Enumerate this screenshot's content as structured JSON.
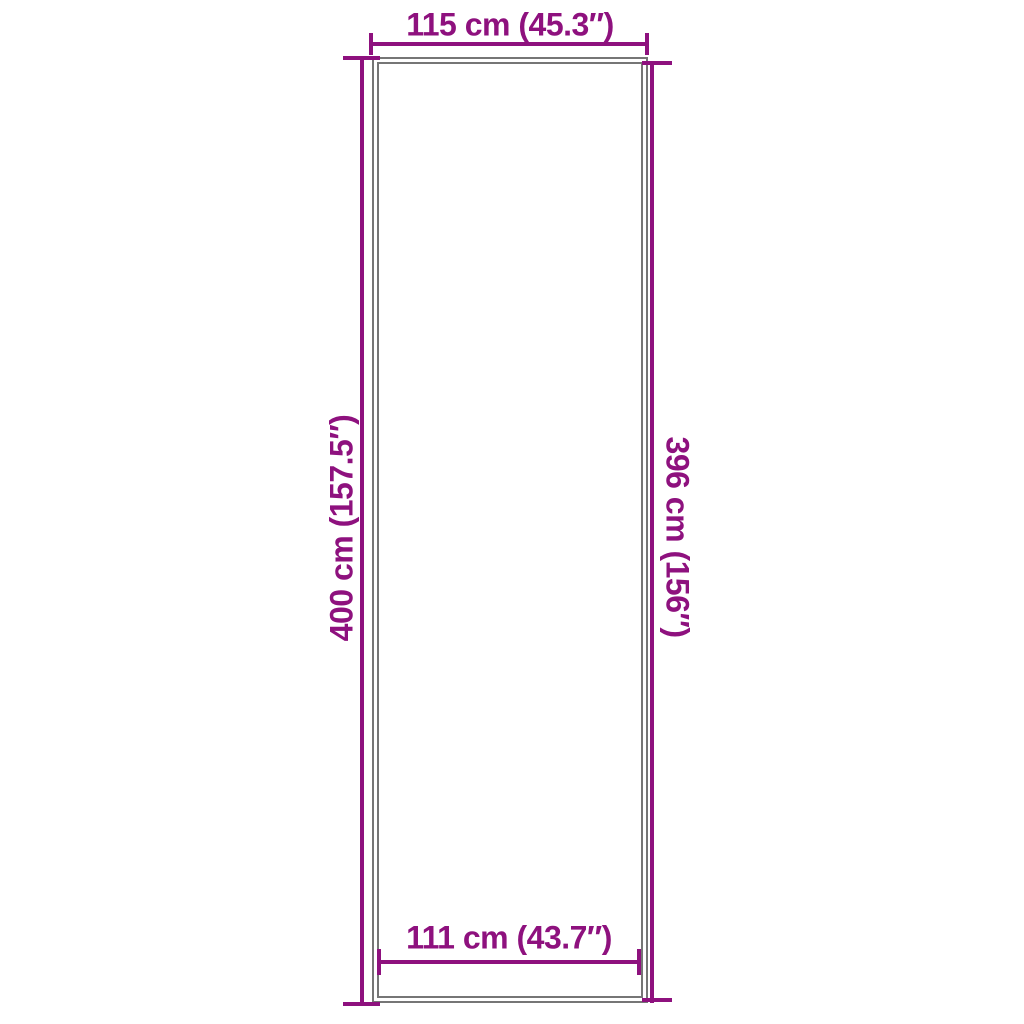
{
  "diagram": {
    "type": "product-dimension-diagram",
    "subject": "rectangular mat outline",
    "colors": {
      "accent": "#8E117E",
      "outline": "#767676",
      "background": "#FFFFFF"
    },
    "dimensions": {
      "top": {
        "label": "115 cm (45.3″)",
        "cm": 115,
        "inches": 45.3
      },
      "left": {
        "label": "400 cm (157.5″)",
        "cm": 400,
        "inches": 157.5
      },
      "right": {
        "label": "396 cm (156″)",
        "cm": 396,
        "inches": 156
      },
      "bottom": {
        "label": "111 cm (43.7″)",
        "cm": 111,
        "inches": 43.7
      }
    }
  }
}
